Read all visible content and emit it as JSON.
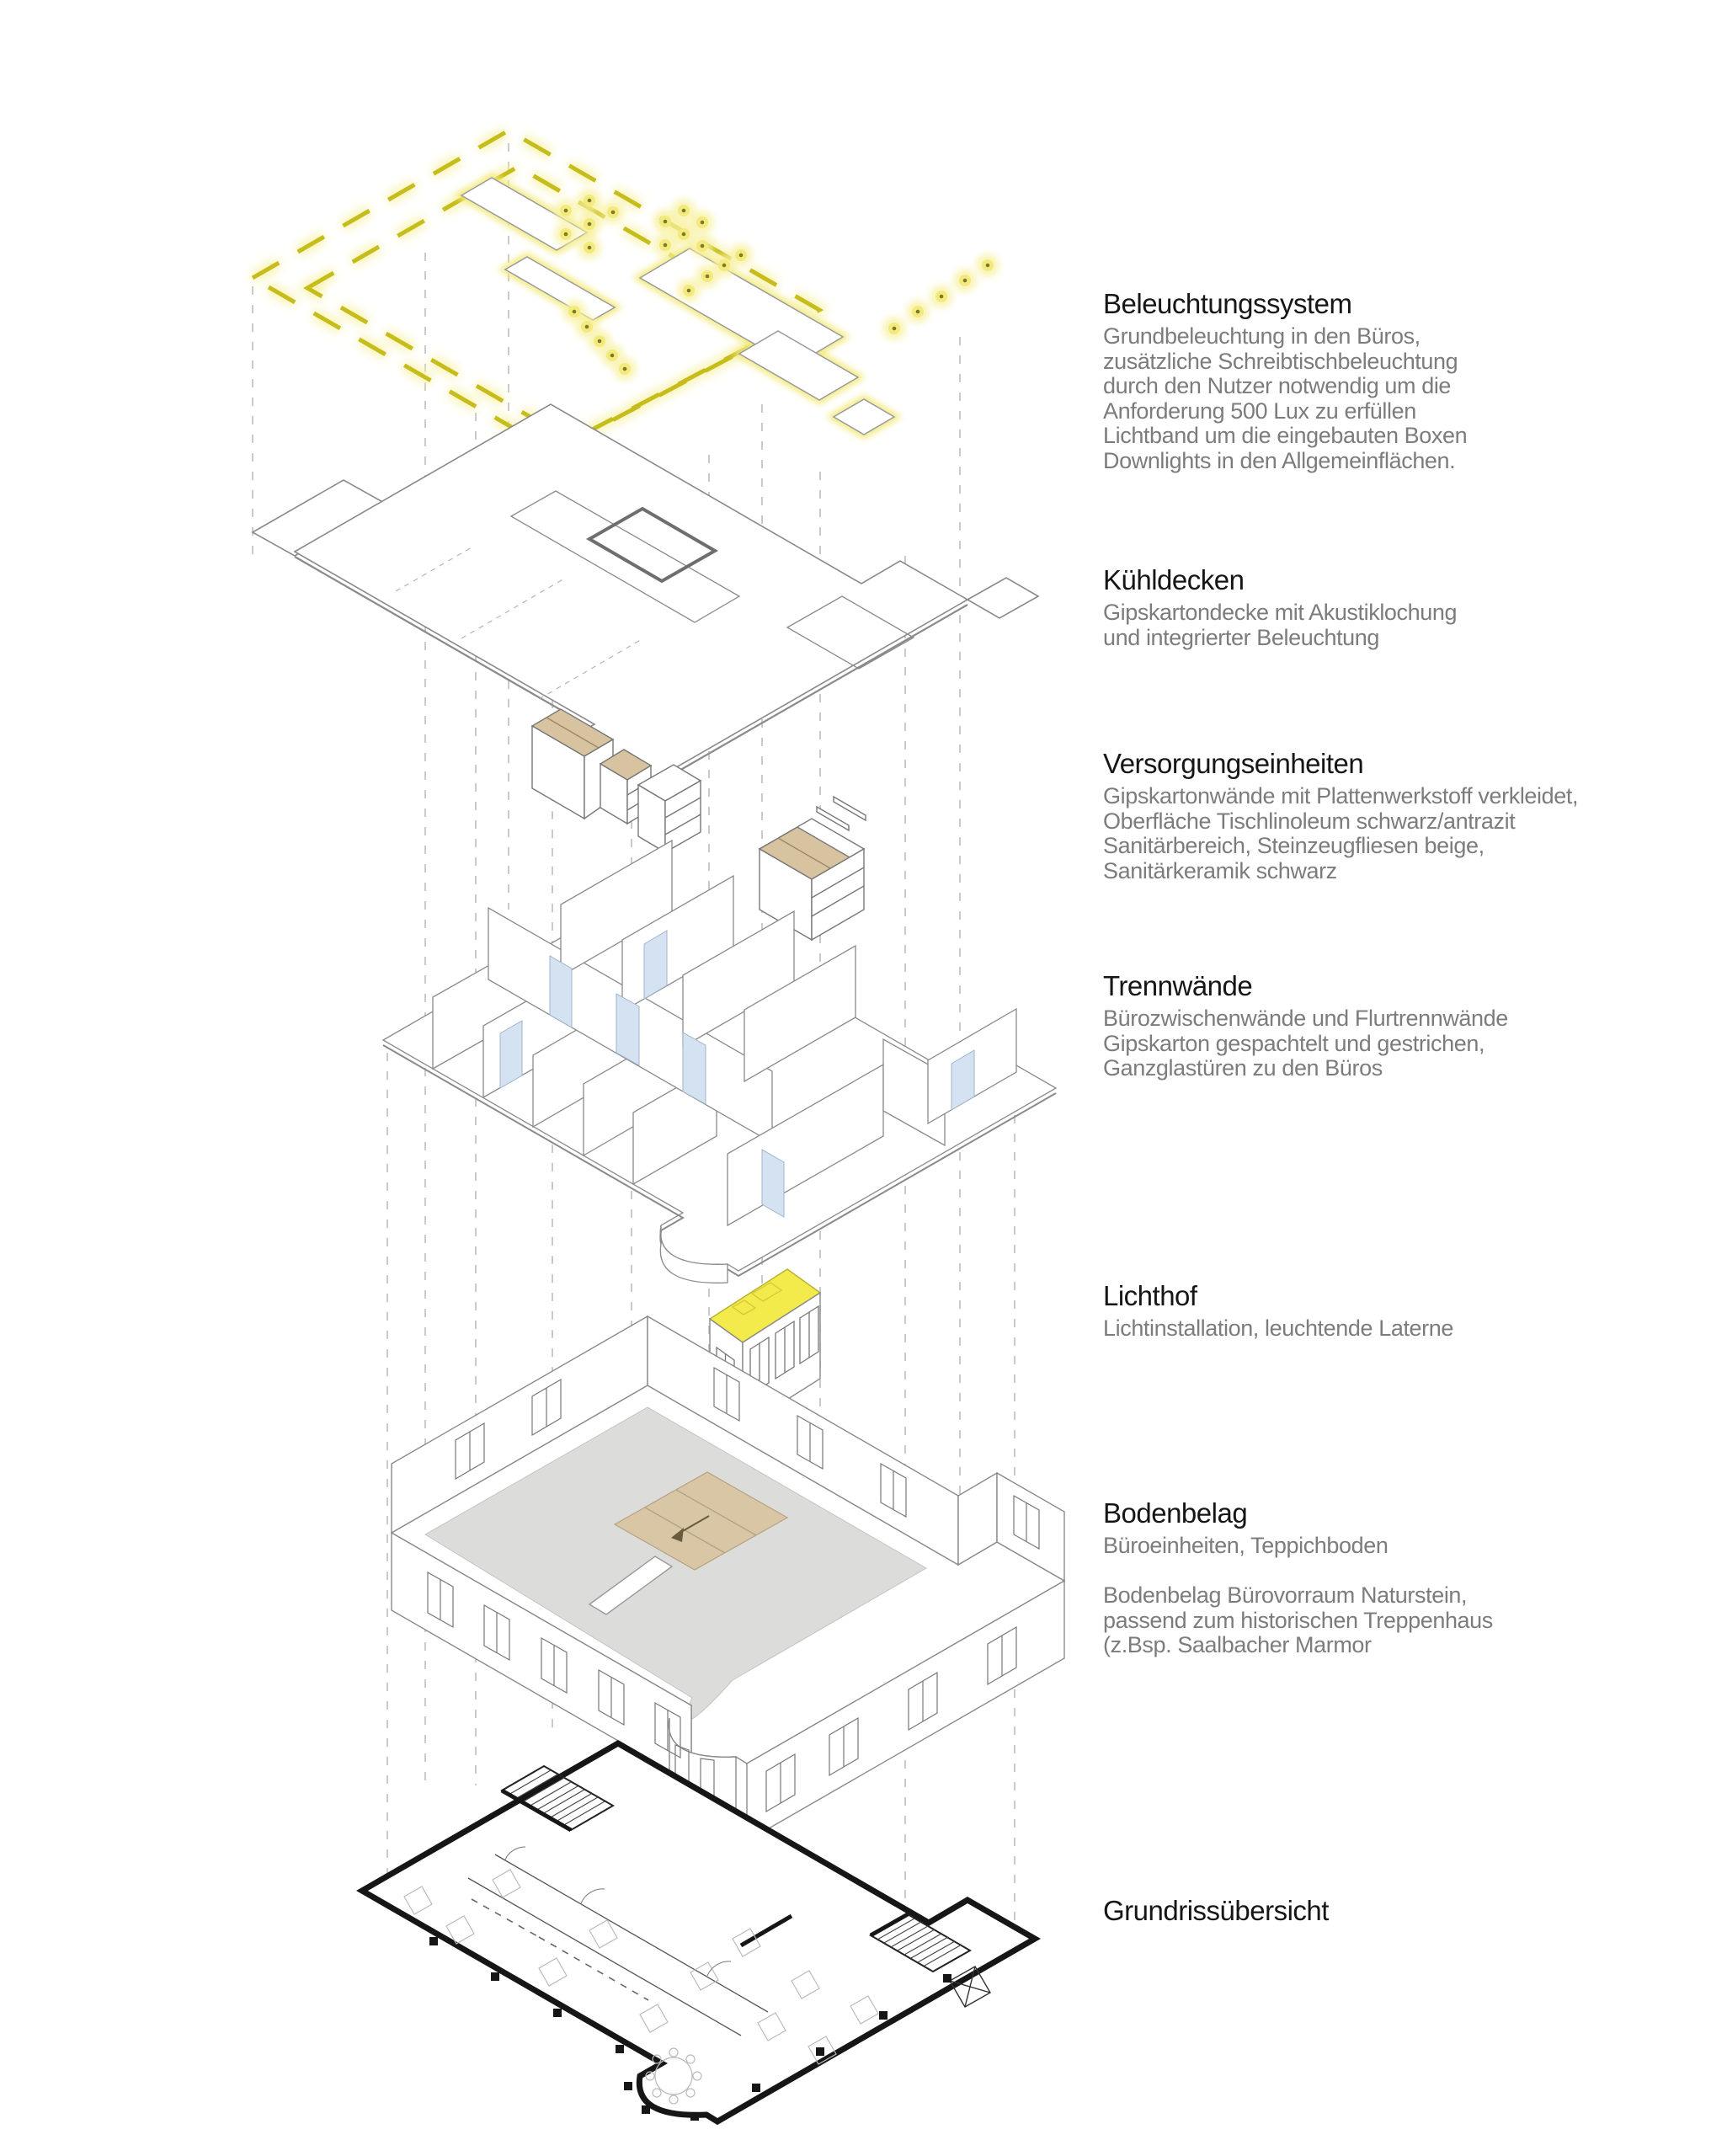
{
  "sections": [
    {
      "id": "beleuchtungssystem",
      "title": "Beleuchtungssystem",
      "body": [
        "Grundbeleuchtung in den Büros,",
        "zusätzliche Schreibtischbeleuchtung",
        "durch den Nutzer notwendig um die",
        "Anforderung 500 Lux zu erfüllen",
        "Lichtband um die eingebauten Boxen",
        "Downlights in den Allgemeinflächen."
      ]
    },
    {
      "id": "kuehldecken",
      "title": "Kühldecken",
      "body": [
        "Gipskartondecke mit Akustiklochung",
        "und integrierter Beleuchtung"
      ]
    },
    {
      "id": "versorgungseinheiten",
      "title": "Versorgungseinheiten",
      "body": [
        "Gipskartonwände mit Plattenwerkstoff verkleidet,",
        "Oberfläche Tischlinoleum schwarz/antrazit",
        "Sanitärbereich, Steinzeugfliesen beige,",
        "Sanitärkeramik schwarz"
      ]
    },
    {
      "id": "trennwaende",
      "title": "Trennwände",
      "body": [
        "Bürozwischenwände und Flurtrennwände",
        "Gipskarton gespachtelt und gestrichen,",
        "Ganzglastüren zu den Büros"
      ]
    },
    {
      "id": "lichthof",
      "title": "Lichthof",
      "body": [
        "Lichtinstallation, leuchtende Laterne"
      ]
    },
    {
      "id": "bodenbelag",
      "title": "Bodenbelag",
      "body": [
        "Büroeinheiten, Teppichboden",
        "",
        "Bodenbelag Bürovorraum Naturstein,",
        "passend zum historischen Treppenhaus",
        "(z.Bsp. Saalbacher Marmor"
      ]
    },
    {
      "id": "grundrissuebersicht",
      "title": "Grundrissübersicht",
      "body": []
    }
  ],
  "colors": {
    "lightband_yellow": "#c6bc1c",
    "light_glow": "#f7f2a6",
    "lichthof_yellow": "#f3eb4c",
    "wood_beige": "#d7c3a0",
    "stone_beige": "#d8c6a5",
    "glass_blue": "#d4e2f2",
    "carpet_gray": "#dcdcda",
    "axon_line_gray": "#8a8a8a",
    "projection_gray": "#bdbdbd",
    "plan_black": "#161616",
    "heading_black": "#161616",
    "body_gray": "#7c7c7c"
  }
}
